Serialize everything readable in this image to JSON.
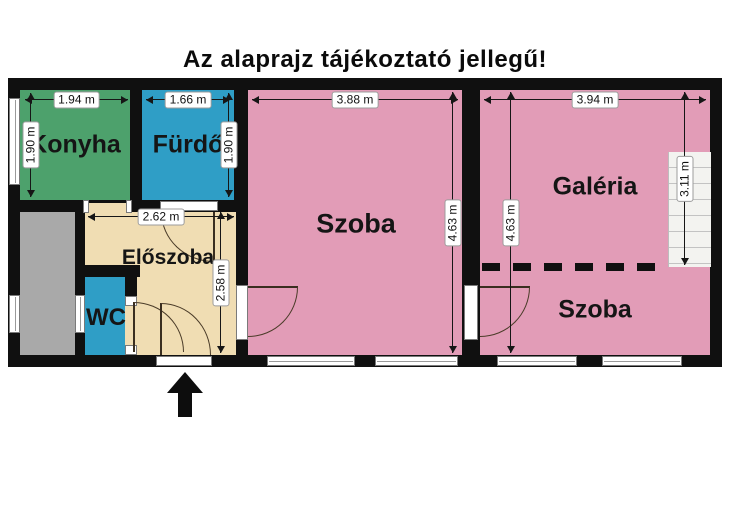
{
  "title": "Az alaprajz tájékoztató jellegű!",
  "rooms": {
    "konyha": {
      "name": "Konyha"
    },
    "furdo": {
      "name": "Fürdő"
    },
    "eloszoba": {
      "name": "Előszoba"
    },
    "wc": {
      "name": "WC"
    },
    "szoba1": {
      "name": "Szoba"
    },
    "galeria": {
      "name": "Galéria"
    },
    "szoba2": {
      "name": "Szoba"
    }
  },
  "dimensions": {
    "konyha_width": "1.94 m",
    "konyha_height": "1.90 m",
    "furdo_width": "1.66 m",
    "furdo_height": "1.90 m",
    "eloszoba_width": "2.62 m",
    "eloszoba_height": "2.58 m",
    "szoba1_width": "3.88 m",
    "szoba1_height": "4.63 m",
    "szoba2_width": "3.94 m",
    "szoba2_height": "4.63 m",
    "stairs_height": "3.11 m"
  },
  "colors": {
    "wall": "#101010",
    "kitchen": "#4da16c",
    "bathroom": "#2f9ec6",
    "hallway": "#f0ddb3",
    "room": "#e29cb7",
    "storage_gray": "#a9a9a9",
    "stairs": "#f3f3f0",
    "background": "#ffffff"
  }
}
